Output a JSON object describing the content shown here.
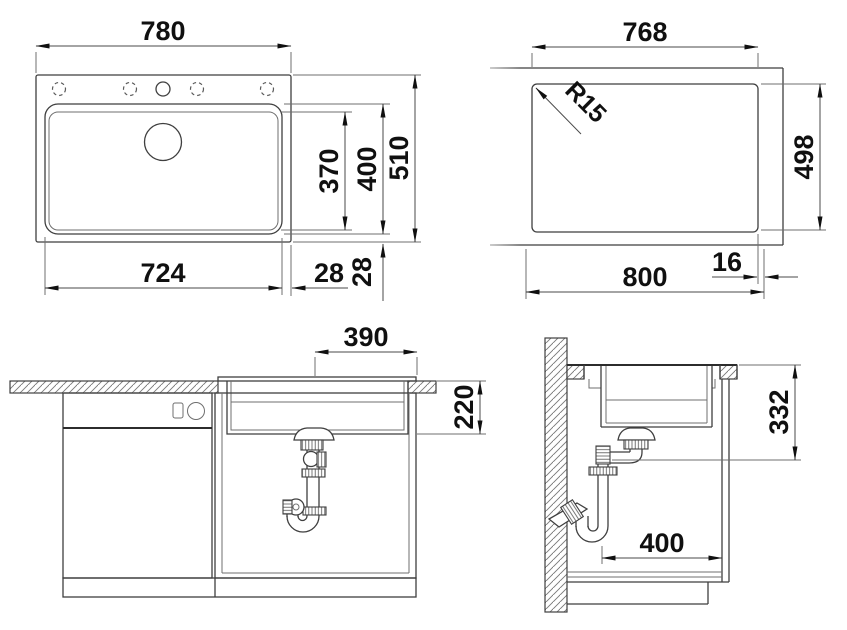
{
  "drawing": {
    "plan_view": {
      "overall_width": "780",
      "bowl_width": "724",
      "bowl_offset_right": "28",
      "bowl_offset_bottom": "28",
      "bowl_inner_length": "370",
      "bowl_outer_length": "400",
      "overall_depth": "510"
    },
    "cutout_view": {
      "cutout_width": "768",
      "corner_radius": "R15",
      "cutout_depth": "498",
      "min_cabinet_width": "800",
      "edge_clearance": "16"
    },
    "front_section_view": {
      "drain_center_offset": "390",
      "bowl_installation_depth": "220"
    },
    "side_section_view": {
      "outlet_height": "332",
      "cabinet_clearance": "400"
    }
  }
}
